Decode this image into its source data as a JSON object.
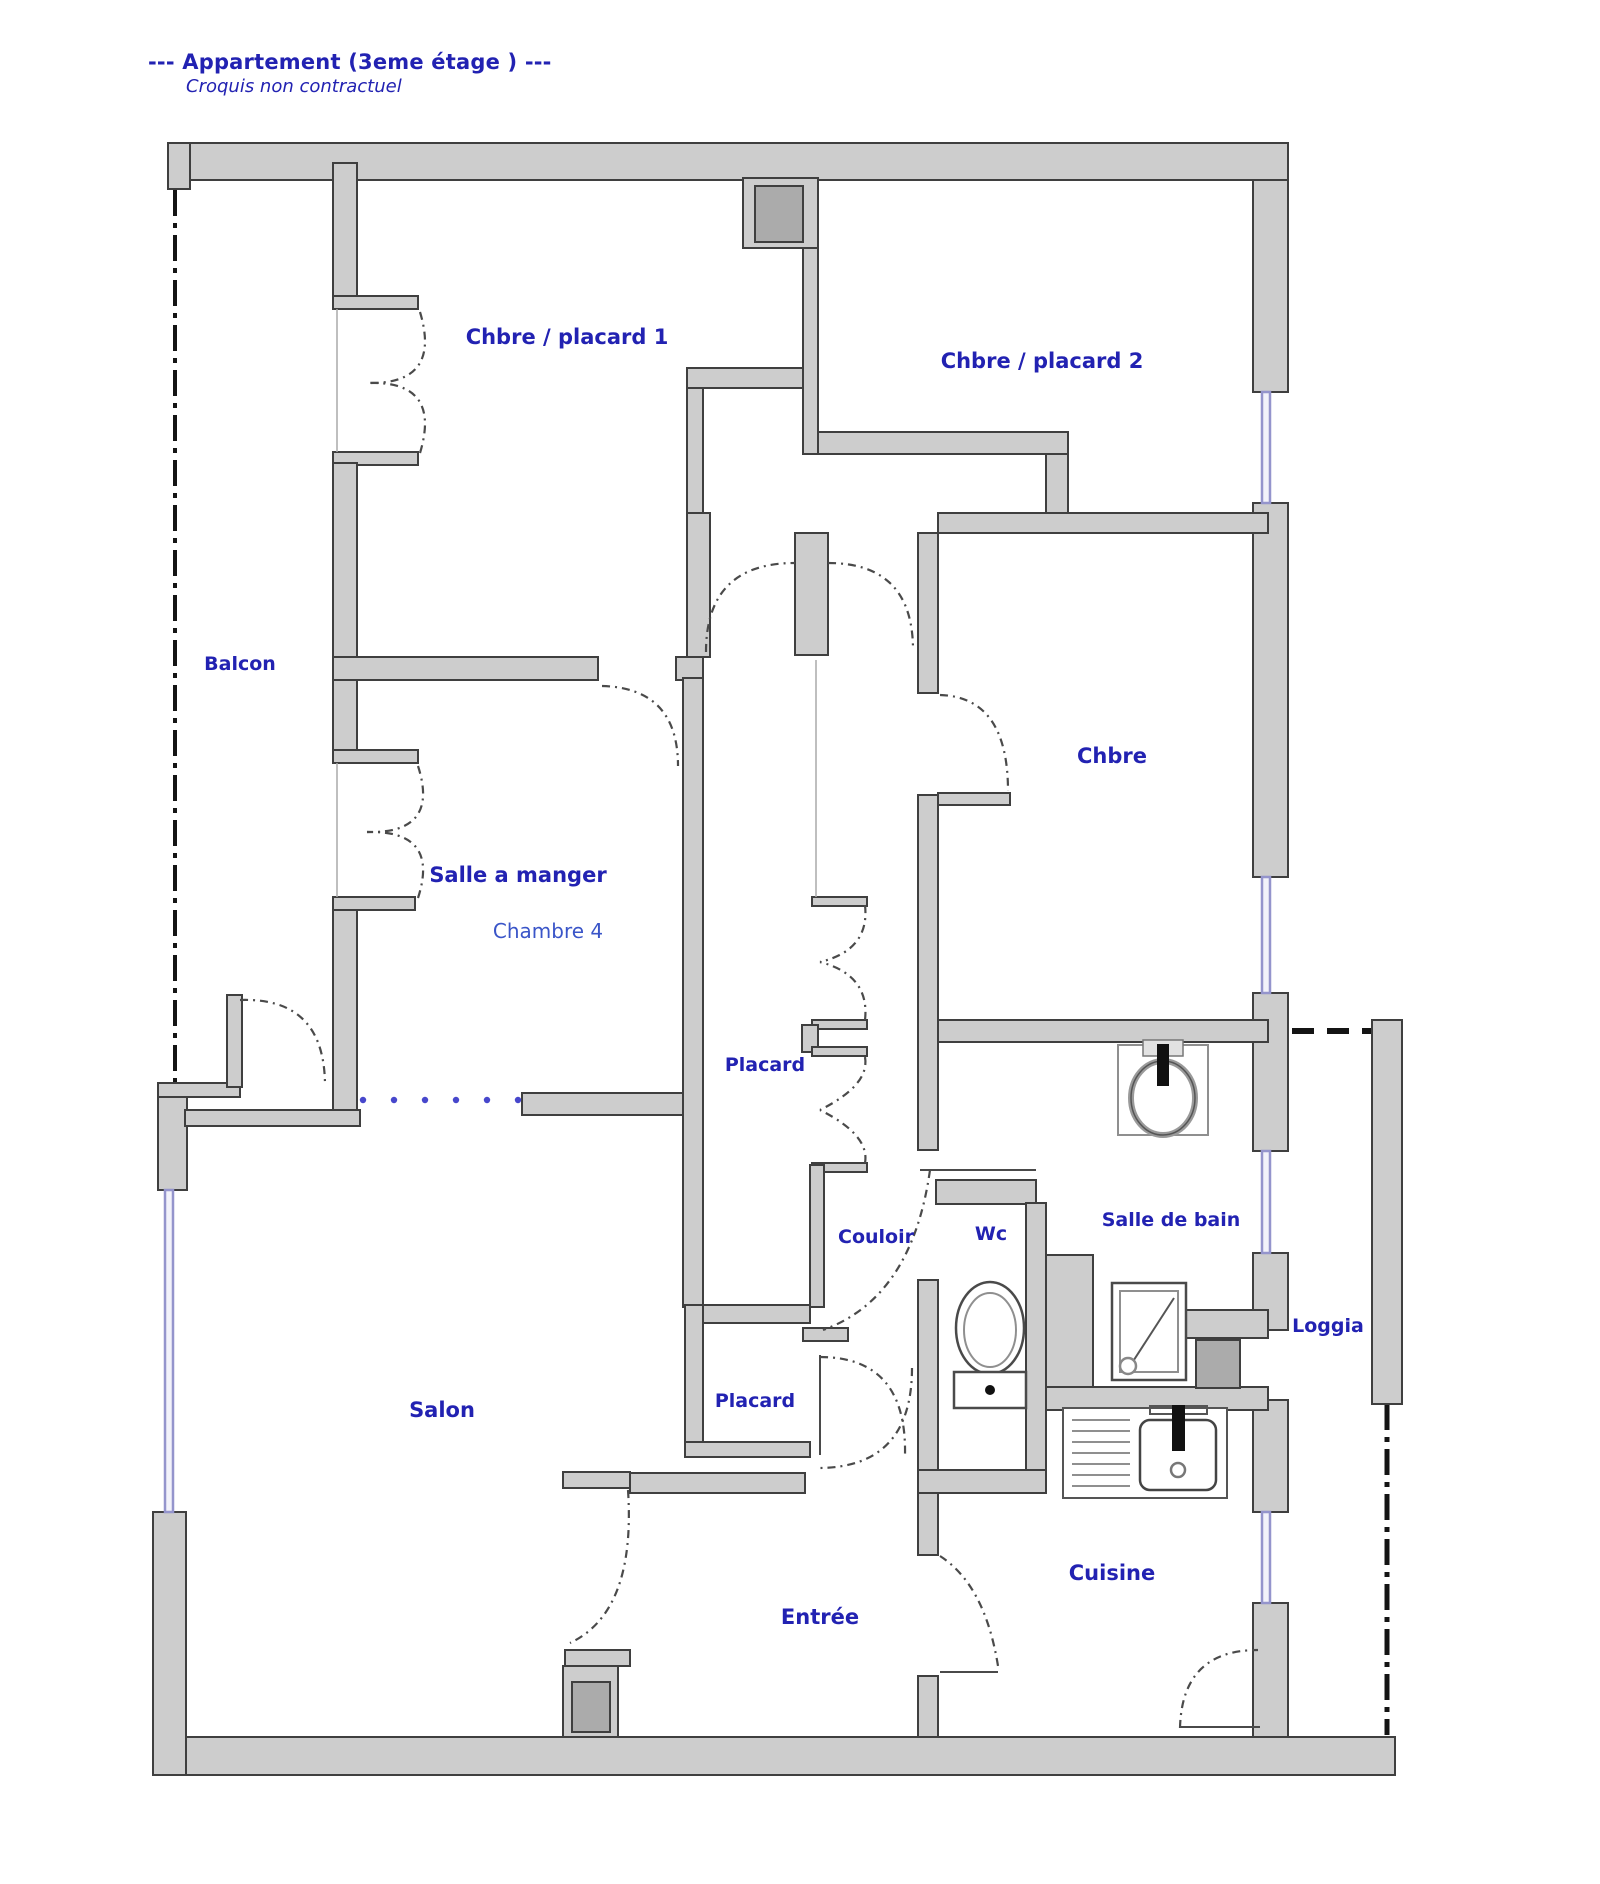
{
  "header": {
    "title": "--- Appartement (3eme étage ) ---",
    "subtitle": "Croquis non contractuel"
  },
  "rooms": {
    "balcon": "Balcon",
    "chbre_placard_1": "Chbre / placard 1",
    "chbre_placard_2": "Chbre / placard 2",
    "chbre": "Chbre",
    "salle_a_manger": "Salle a manger",
    "chambre_4": "Chambre 4",
    "placard_1": "Placard",
    "couloir": "Couloir",
    "wc": "Wc",
    "salle_de_bain": "Salle de bain",
    "loggia": "Loggia",
    "salon": "Salon",
    "placard_2": "Placard",
    "entree": "Entrée",
    "cuisine": "Cuisine"
  },
  "icons": {
    "toilet": "toilet-icon",
    "washbasin": "washbasin-icon",
    "shower": "shower-icon",
    "kitchen_sink": "kitchen-sink-icon"
  },
  "colors": {
    "c-label": "#2222b2",
    "c-label-light": "#3a55c8",
    "c-wall": "#cdcdcd",
    "c-wall-stroke": "#3f3f3f",
    "c-window": "#9494cc",
    "c-boundary": "#141414"
  }
}
